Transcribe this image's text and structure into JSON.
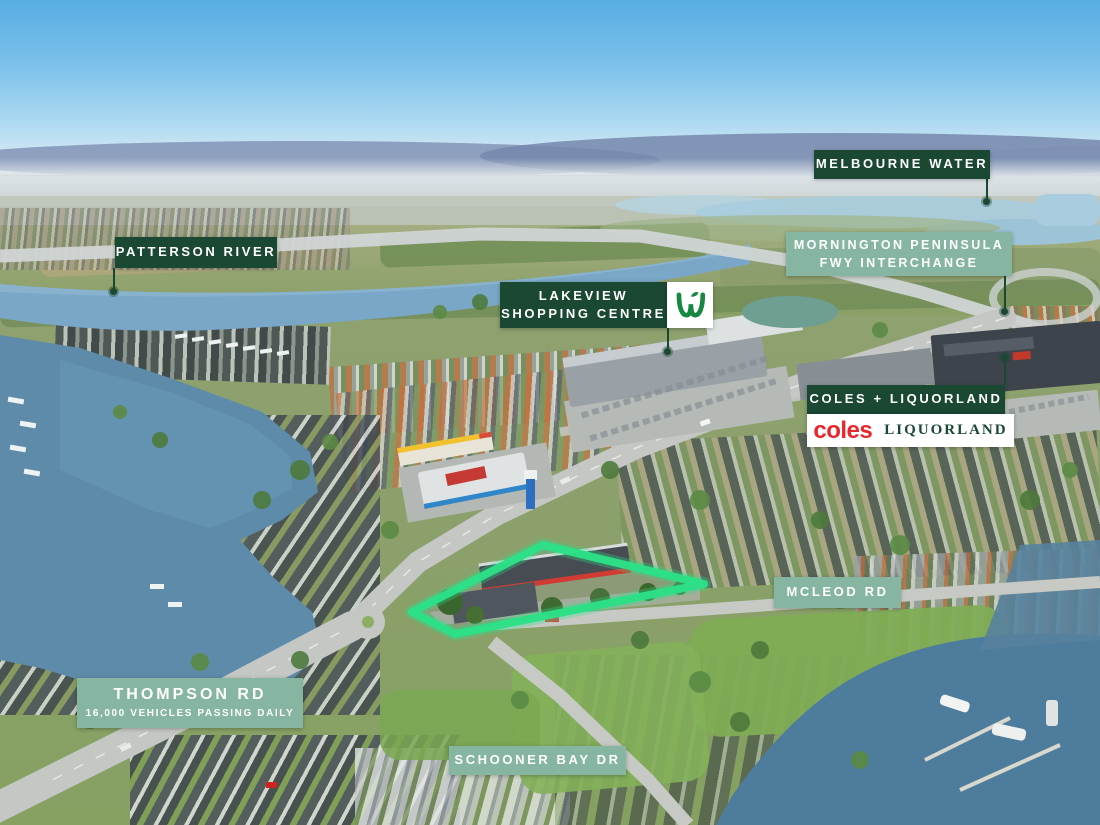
{
  "image": {
    "type": "aerial-drone-photo-with-location-labels",
    "subject": "highlighted development site outlined in green at a road intersection"
  },
  "colors": {
    "label_dark_green": "#1a4833",
    "label_sage_green": "#86b5a2",
    "label_text": "#ffffff",
    "site_outline_green": "#2be087",
    "leader_line_green": "#1a4833",
    "coles_logo_red": "#e8262c",
    "liquorland_logo_green": "#1a4833",
    "woolworths_logo_green": "#178841"
  },
  "labels": {
    "melbourne_water": "MELBOURNE WATER",
    "patterson_river": "PATTERSON RIVER",
    "mornington_line1": "MORNINGTON PENINSULA",
    "mornington_line2": "FWY INTERCHANGE",
    "lakeview_line1": "LAKEVIEW",
    "lakeview_line2": "SHOPPING CENTRE",
    "coles_liquorland": "COLES + LIQUORLAND",
    "coles_logo": "coles",
    "liquorland_logo": "LIQUORLAND",
    "mcleod_rd": "MCLEOD RD",
    "thompson_line1": "THOMPSON RD",
    "thompson_line2": "16,000 VEHICLES PASSING DAILY",
    "schooner_bay": "SCHOONER BAY DR"
  }
}
